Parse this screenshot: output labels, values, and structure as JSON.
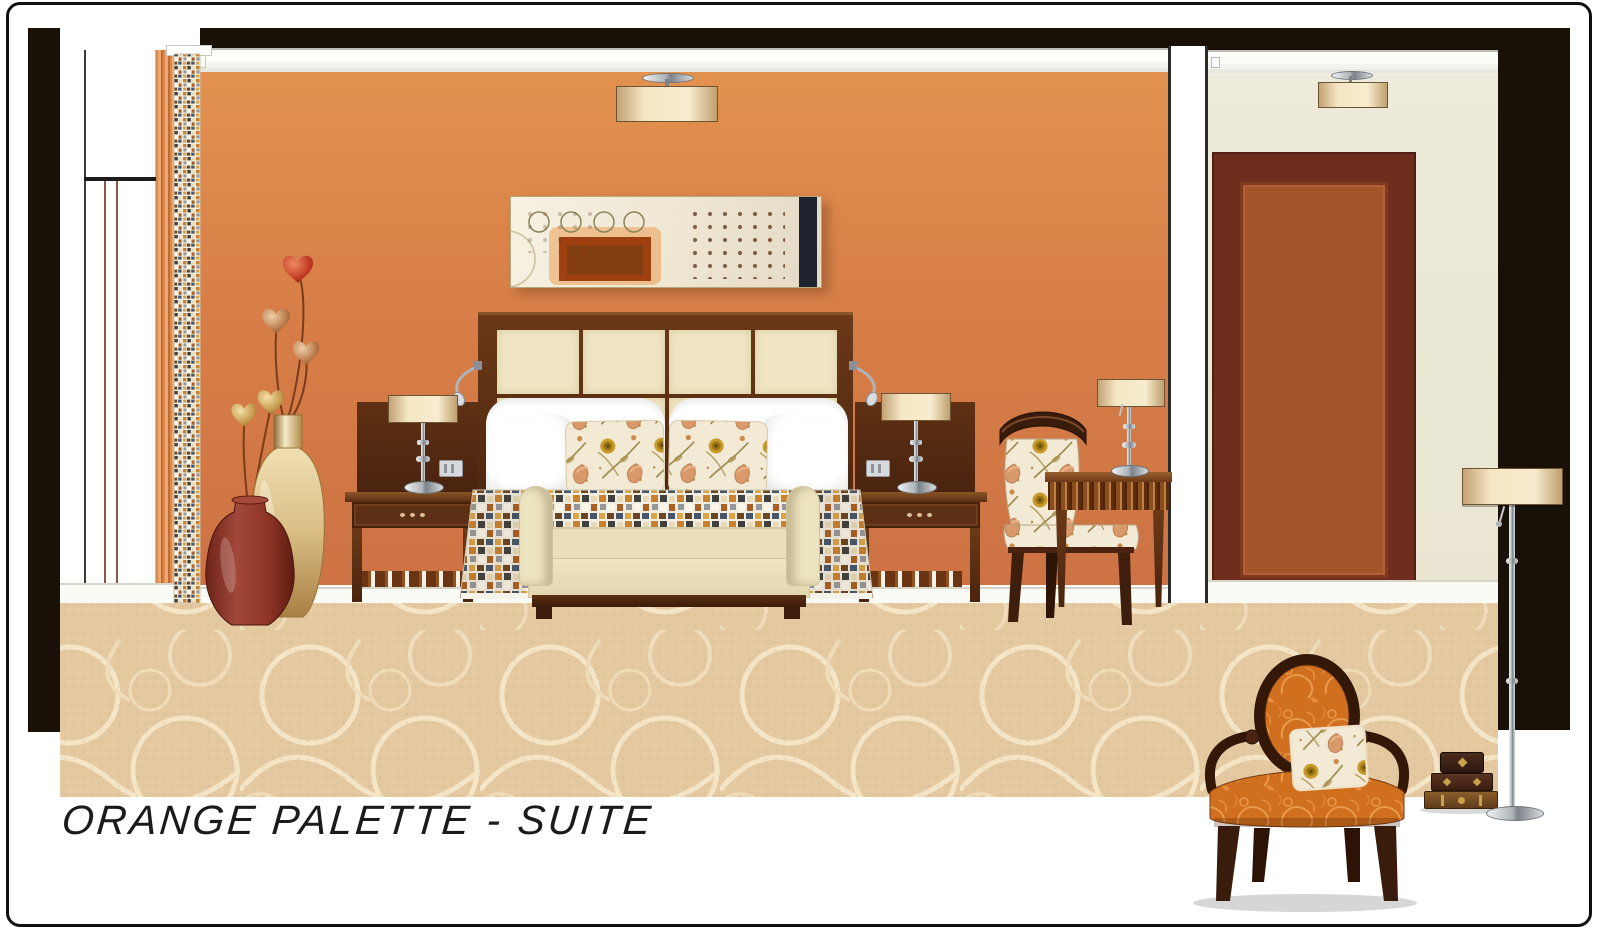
{
  "title": {
    "text": "ORANGE PALETTE - SUITE"
  },
  "palette": {
    "frame_black": "#191008",
    "wall_orange_top": "#e0904f",
    "wall_orange_bottom": "#cd7243",
    "wall_cream": "#edeadb",
    "door_frame": "#6f2d1d",
    "door_panel": "#a2552a",
    "wood_dark": "#4a2511",
    "upholstery_cream": "#ece3bf",
    "carpet_beige": "#e4c9a0",
    "accent_orange_damask": "#d06f1e",
    "accent_red_vase": "#8f3526"
  },
  "objects": [
    "pendant-drum-light",
    "abstract-wall-art",
    "upholstered-headboard",
    "bed-pillows",
    "floral-accent-pillows",
    "mosaic-bed-skirt",
    "bedside-table-lamp",
    "nightstand",
    "light-switch",
    "rolled-arm-bench",
    "fluted-console-desk",
    "floral-side-chair",
    "heart-stem-vases",
    "mosaic-tile-column",
    "window-sheer",
    "entry-door",
    "swirl-carpet",
    "orange-damask-chair",
    "stacked-antique-boxes",
    "chrome-floor-lamp"
  ]
}
